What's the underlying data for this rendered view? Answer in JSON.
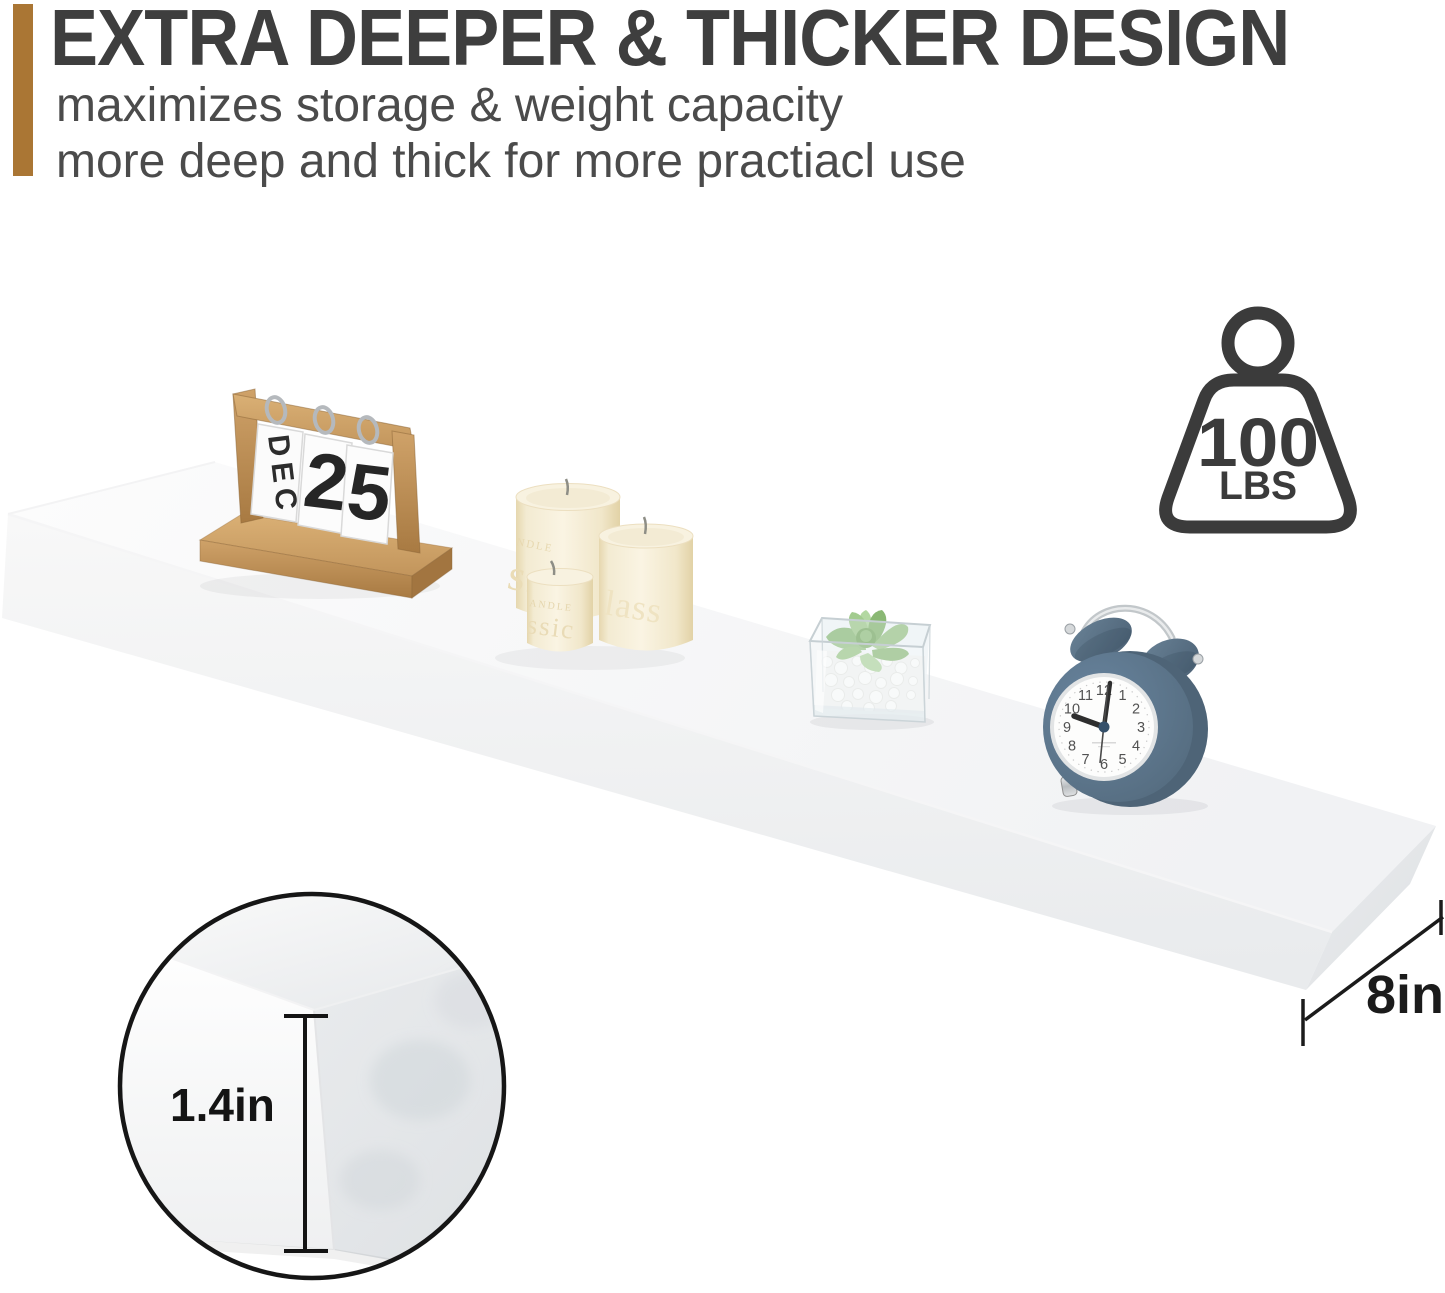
{
  "header": {
    "accent_color": "#aa7634",
    "title": "EXTRA DEEPER & THICKER DESIGN",
    "subtitle_line1": "maximizes storage & weight capacity",
    "subtitle_line2": "more deep and thick for more practiacl use"
  },
  "weight_badge": {
    "value": "100",
    "unit": "LBS",
    "ink_color": "#3b3b3b"
  },
  "dimensions": {
    "depth_label": "8in",
    "thickness_label": "1.4in",
    "ink_color": "#1b1b1b"
  },
  "shelf": {
    "color": "#ffffff",
    "front_color": "#eef0f1"
  },
  "calendar": {
    "month": "DEC",
    "day_tens": "2",
    "day_ones": "5",
    "wood_color": "#c0905a"
  },
  "candles": {
    "embossed_brand_large": "NDLE",
    "embossed_large": "ssic",
    "embossed_medium": "lass",
    "embossed_brand_small": "ANDLE",
    "embossed_small": "ssic",
    "wax_color": "#f7efda"
  },
  "clock": {
    "numbers": [
      "12",
      "1",
      "2",
      "3",
      "4",
      "5",
      "6",
      "7",
      "8",
      "9",
      "10",
      "11"
    ],
    "body_color": "#5d7689"
  }
}
